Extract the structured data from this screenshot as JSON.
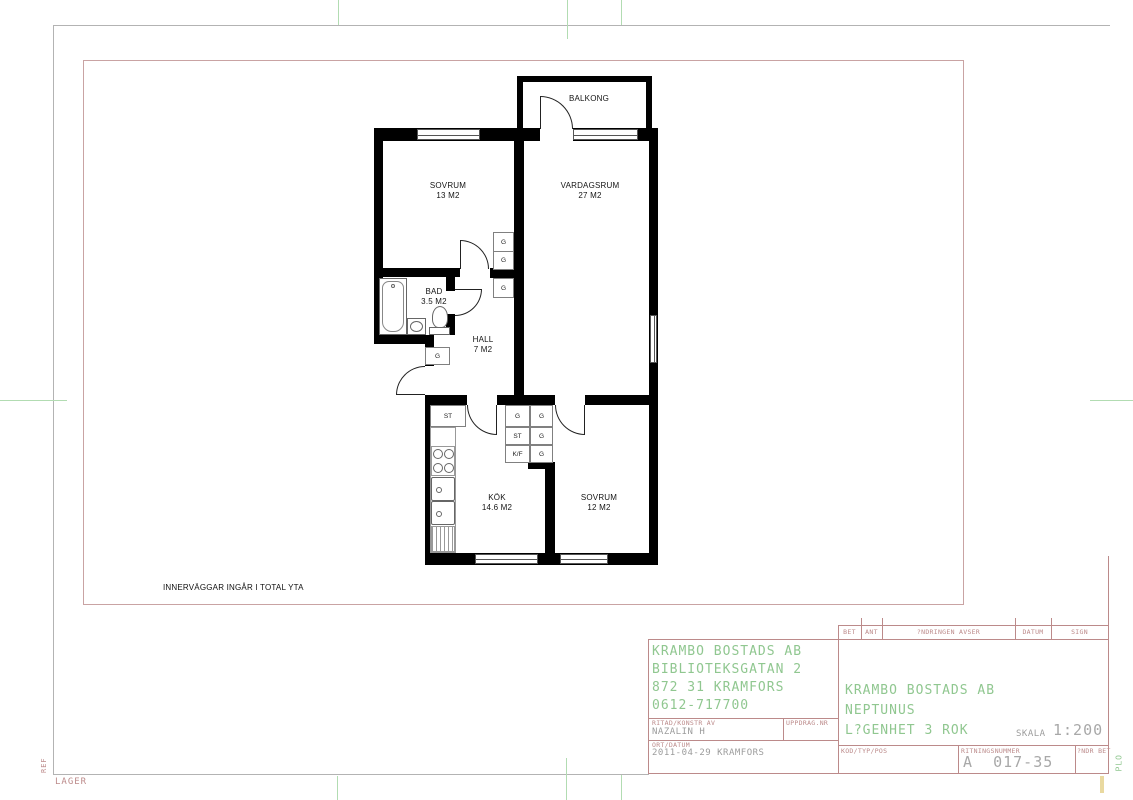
{
  "colors": {
    "wall_black": "#000000",
    "line_pink": "#bc8a8a",
    "frame_pink": "#c9a3a3",
    "border_gray": "#b3b3b3",
    "cad_green": "#90c790",
    "value_gray": "#9c9c9c",
    "fold_green": "#b2dcb2",
    "mark_yellow": "#e9d9a0"
  },
  "note": "INNERVÄGGAR INGÅR I TOTAL YTA",
  "margin": {
    "ref": "REF",
    "lager": "LAGER",
    "plo": "PLO"
  },
  "plan": {
    "rooms": {
      "balkong": {
        "name": "BALKONG"
      },
      "sovrum1": {
        "name": "SOVRUM",
        "area": "13 M2"
      },
      "vardagsrum": {
        "name": "VARDAGSRUM",
        "area": "27 M2"
      },
      "bad": {
        "name": "BAD",
        "area": "3.5 M2"
      },
      "hall": {
        "name": "HALL",
        "area": "7 M2"
      },
      "kok": {
        "name": "KÖK",
        "area": "14.6 M2"
      },
      "sovrum2": {
        "name": "SOVRUM",
        "area": "12 M2"
      }
    },
    "closets": {
      "g": "G",
      "st": "ST",
      "kf": "K/F"
    }
  },
  "title_block": {
    "company": [
      "KRAMBO BOSTADS AB",
      "BIBLIOTEKSGATAN 2",
      "872 31 KRAMFORS",
      "0612-717700"
    ],
    "project": [
      "KRAMBO BOSTADS AB",
      "NEPTUNUS",
      "L?GENHET 3 ROK"
    ],
    "labels": {
      "ritad": "RITAD/KONSTR AV",
      "uppdrag": "UPPDRAG.NR",
      "ort": "ORT/DATUM",
      "kod": "KOD/TYP/POS",
      "ritningsnummer": "RITNINGSNUMMER",
      "andr_bet": "?NDR BET",
      "skala": "SKALA",
      "bet": "BET",
      "ant": "ANT",
      "andringen": "?NDRINGEN AVSER",
      "datum": "DATUM",
      "sign": "SIGN"
    },
    "values": {
      "ritad": "NAZALIN H",
      "ort": "2011-04-29 KRAMFORS",
      "skala": "1:200",
      "ritningsnummer": "A  017-35"
    }
  }
}
